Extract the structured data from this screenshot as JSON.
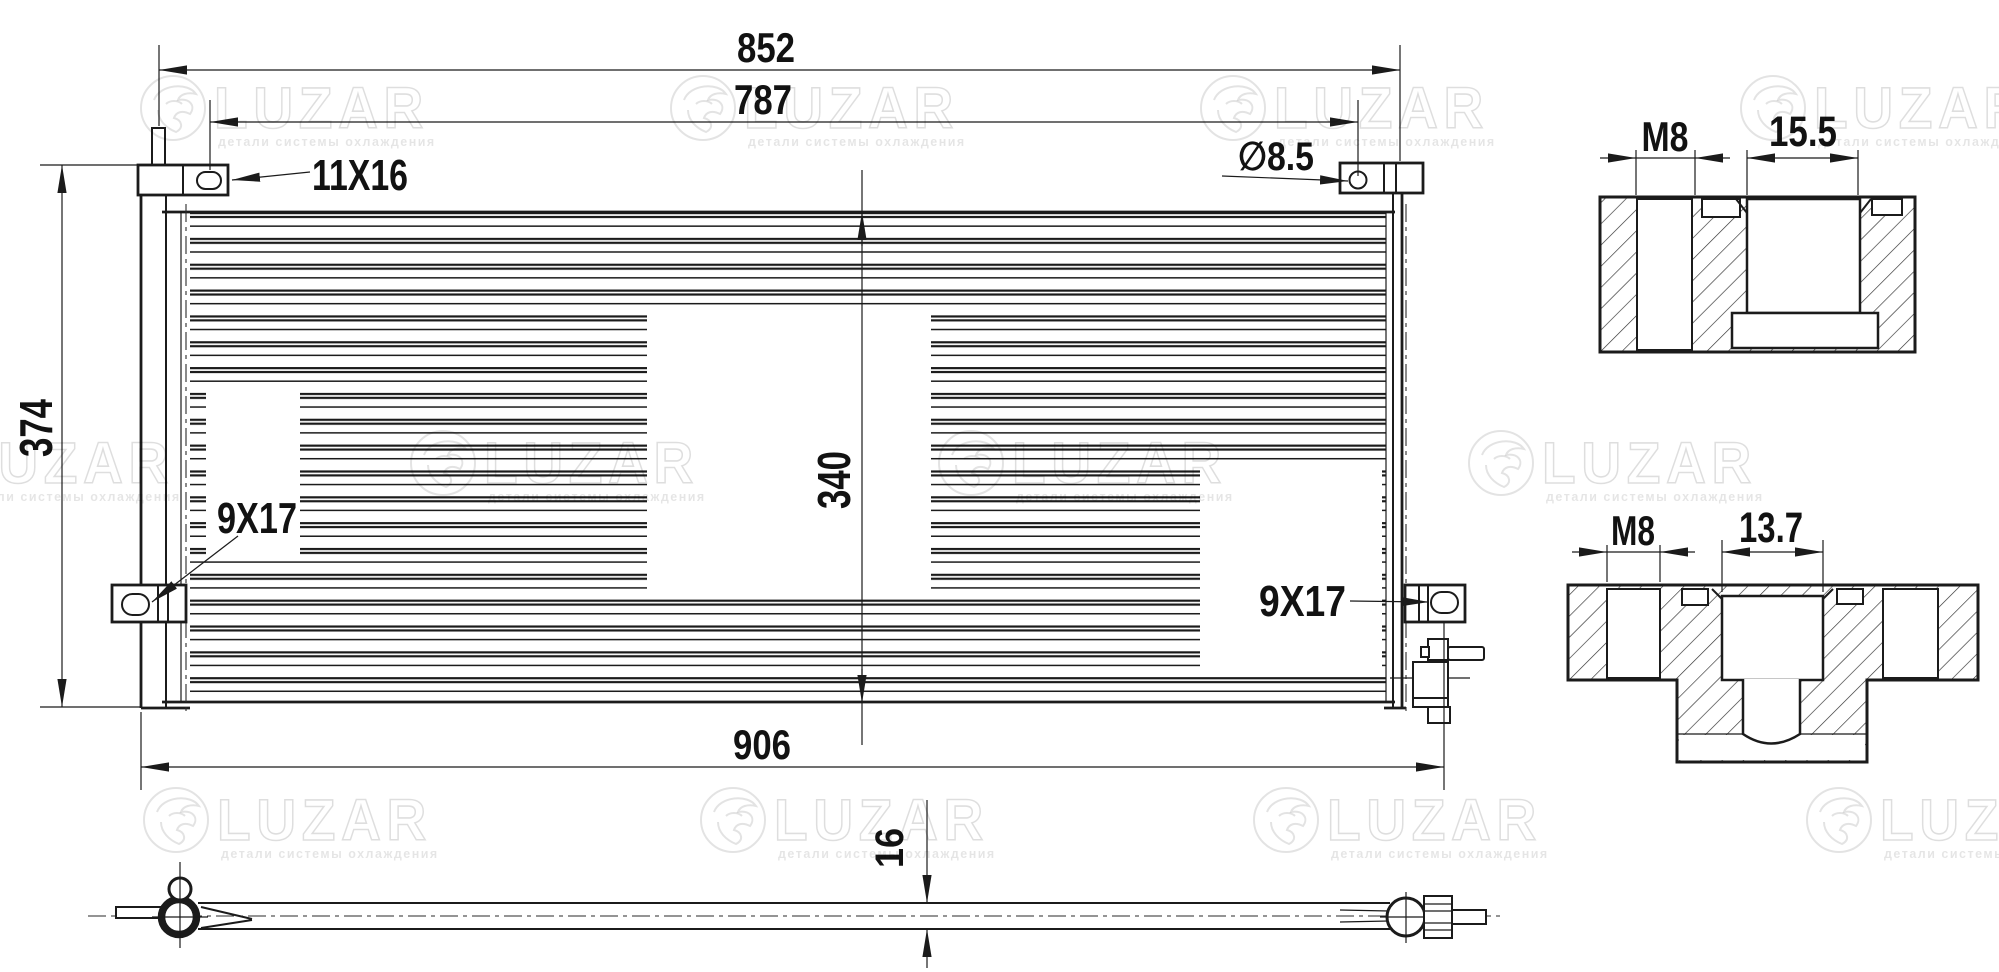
{
  "drawing": {
    "type": "condenser-technical-drawing",
    "colors": {
      "background": "#ffffff",
      "line": "#1b1b1b",
      "watermark": "rgba(0,0,0,0.12)"
    },
    "main_view": {
      "dims": {
        "overall_width": "852",
        "mount_span": "787",
        "overall_height": "374",
        "core_height": "340",
        "total_width": "906"
      },
      "callouts": {
        "slot_top_left": "11X16",
        "hole_top_right": "∅8.5",
        "slot_bottom_left": "9X17",
        "slot_bottom_right": "9X17"
      }
    },
    "bottom_view": {
      "thickness": "16"
    },
    "detail_top": {
      "thread": "M8",
      "pocket_width": "15.5"
    },
    "detail_bottom": {
      "thread": "M8",
      "pocket_width": "13.7"
    },
    "watermark": {
      "brand": "LUZAR",
      "tagline": "детали системы охлаждения"
    }
  }
}
